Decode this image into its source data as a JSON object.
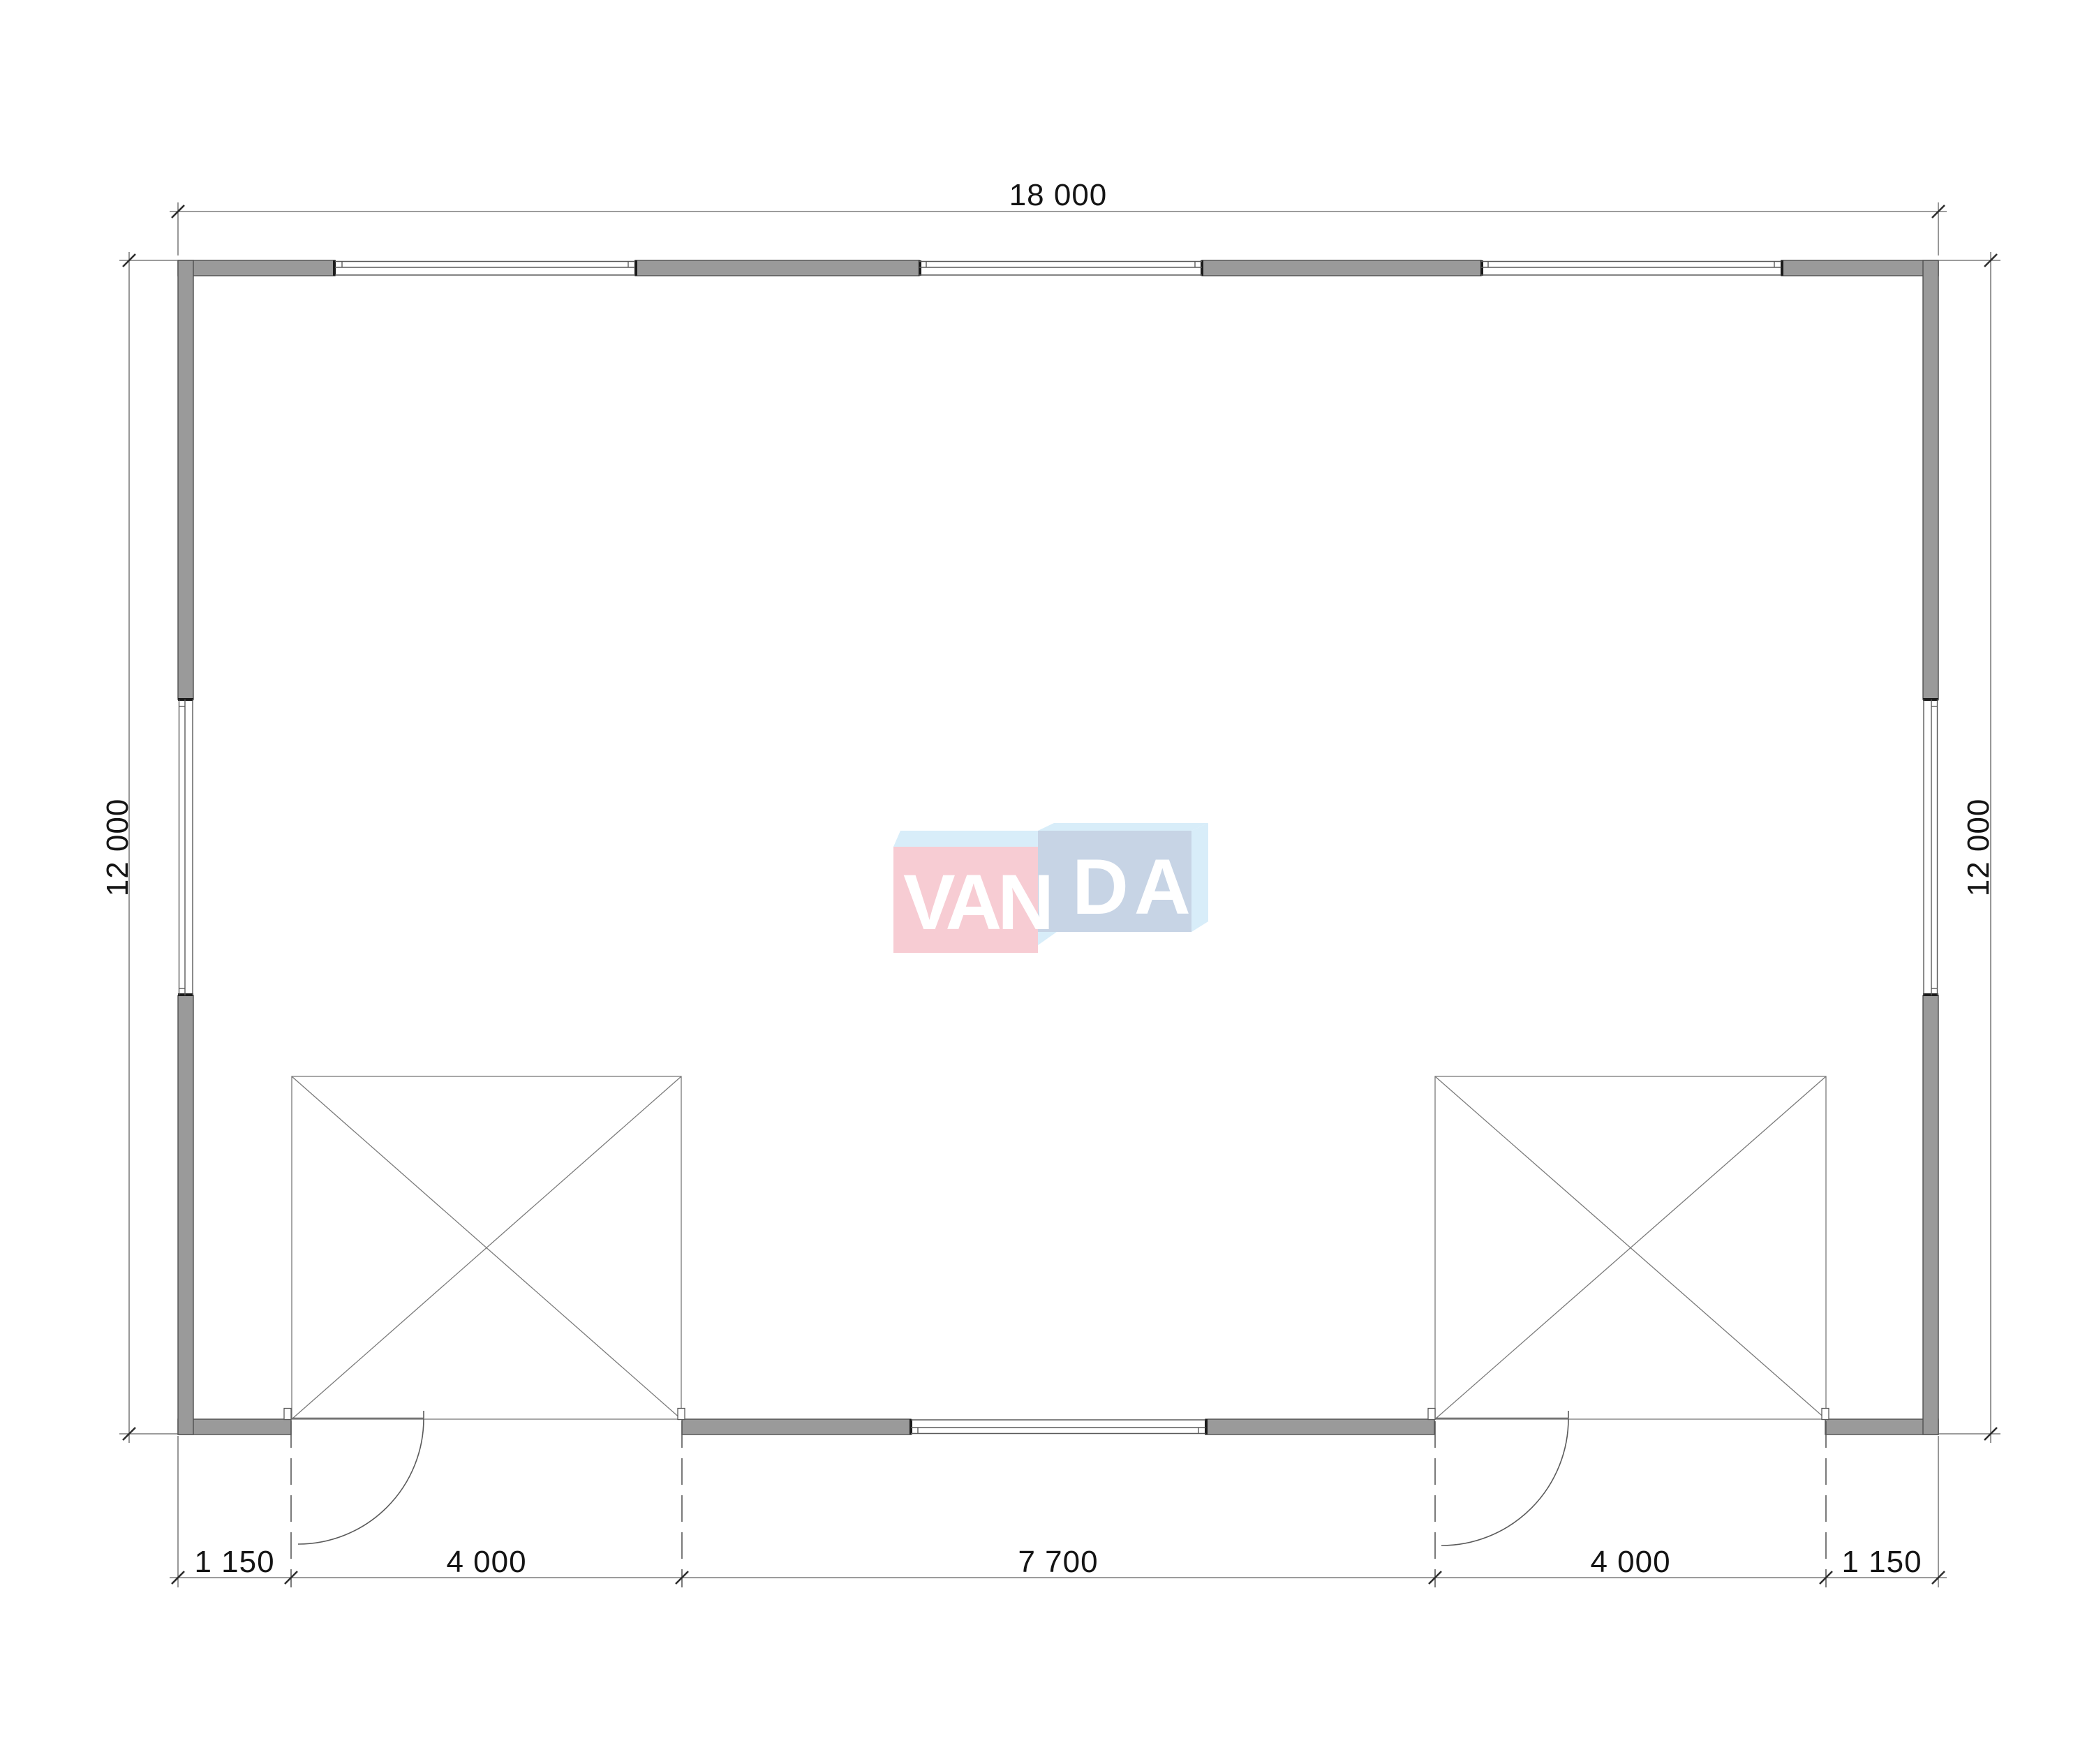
{
  "drawing": {
    "type": "floor-plan",
    "dimensions": {
      "top": {
        "label": "18 000"
      },
      "left": {
        "label": "12 000"
      },
      "right": {
        "label": "12 000"
      },
      "bottom": {
        "labels": [
          "1 150",
          "4 000",
          "7 700",
          "4 000",
          "1 150"
        ]
      }
    }
  },
  "watermark": {
    "brand": "VANDA",
    "text_left": "VAN",
    "text_right": "DA"
  },
  "colors": {
    "bg": "#ffffff",
    "wall_fill": "#9a9a9a",
    "wall_edge": "#4f4f4f",
    "cap": "#1b1b1b",
    "line": "#5a5a5a",
    "light_line": "#7a7a7a",
    "dim_line": "#606060",
    "tick": "#2e2e2e",
    "dim_text": "#141414",
    "logo_pink": "#f7ccd3",
    "logo_blue_front": "#c7d4e5",
    "logo_blue_light": "#d8edf9",
    "logo_text": "#ffffff"
  }
}
